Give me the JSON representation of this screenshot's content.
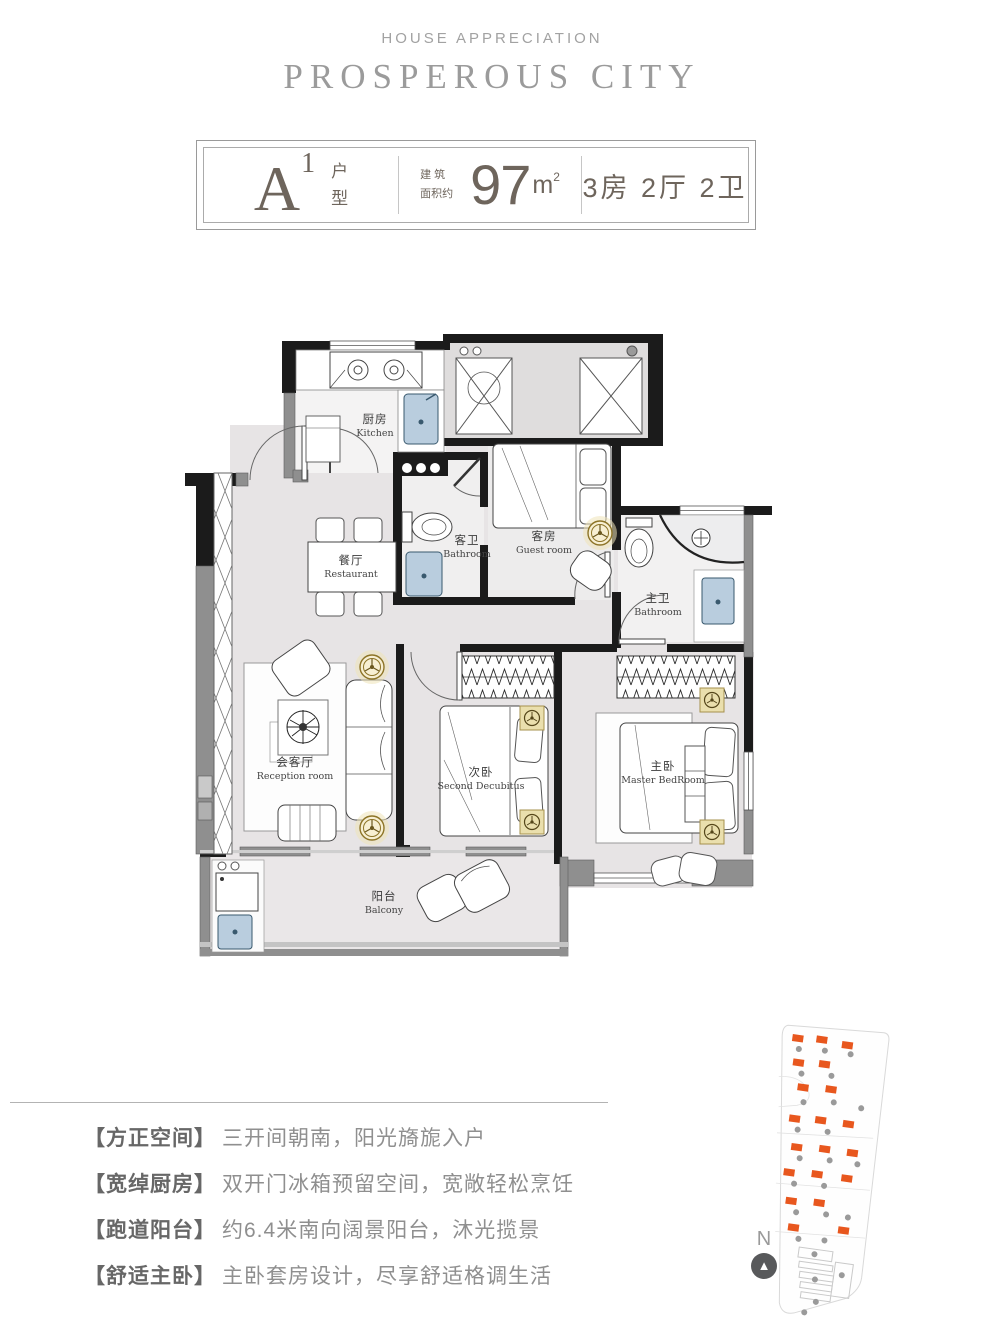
{
  "header": {
    "eyebrow": "HOUSE APPRECIATION",
    "title": "PROSPEROUS CITY"
  },
  "badge": {
    "unit": "A",
    "unit_sup": "1",
    "unit_label_1": "户",
    "unit_label_2": "型",
    "area_prefix_1": "建 筑",
    "area_prefix_2": "面积约",
    "area_value": "97",
    "area_unit": "m",
    "area_unit_sup": "2",
    "layout": "3房 2厅 2卫"
  },
  "plan": {
    "rooms": [
      {
        "zh": "厨房",
        "en": "Kitchen"
      },
      {
        "zh": "餐厅",
        "en": "Restaurant"
      },
      {
        "zh": "客卫",
        "en": "Bathroom"
      },
      {
        "zh": "客房",
        "en": "Guest room"
      },
      {
        "zh": "主卫",
        "en": "Bathroom"
      },
      {
        "zh": "会客厅",
        "en": "Reception room"
      },
      {
        "zh": "次卧",
        "en": "Second Decubitus"
      },
      {
        "zh": "主卧",
        "en": "Master BedRoom"
      },
      {
        "zh": "阳台",
        "en": "Balcony"
      }
    ]
  },
  "features": [
    {
      "tag": "【方正空间】",
      "desc": "三开间朝南，阳光旖旎入户"
    },
    {
      "tag": "【宽绰厨房】",
      "desc": "双开门冰箱预留空间，宽敞轻松烹饪"
    },
    {
      "tag": "【跑道阳台】",
      "desc": "约6.4米南向阔景阳台，沐光揽景"
    },
    {
      "tag": "【舒适主卧】",
      "desc": "主卧套房设计，尽享舒适格调生活"
    }
  ],
  "compass": {
    "label": "N"
  },
  "colors": {
    "wall": "#1b1b1b",
    "wall_gray": "#8f8f8f",
    "floor": "#e7e4e5",
    "light_gold": "#8d7427",
    "fixture_blue": "#b9cdde",
    "site_orange": "#e8571e",
    "text_dark": "#6e655c",
    "text_gray": "#8f8f8f"
  }
}
